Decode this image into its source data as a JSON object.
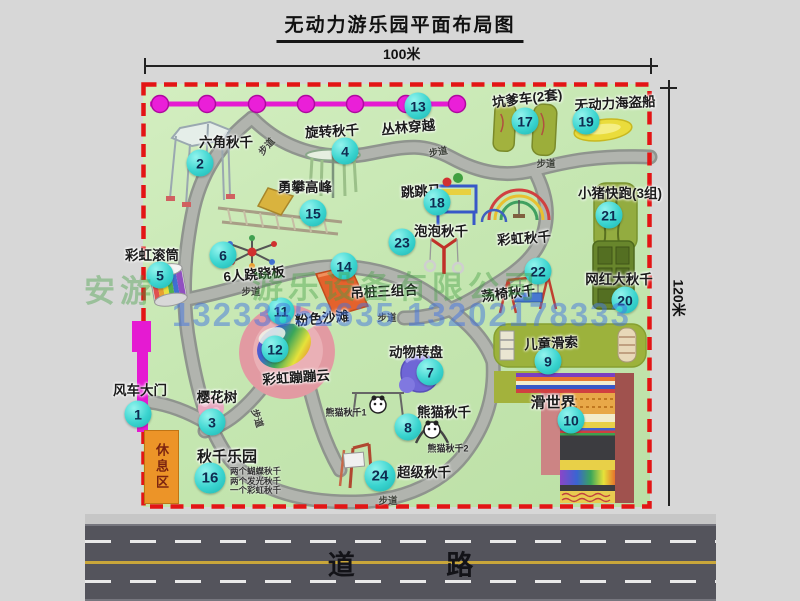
{
  "title": "无动力游乐园平面布局图",
  "dimensions": {
    "width_label": "100米",
    "height_label": "120米"
  },
  "road_label": "道 路",
  "walkway_label": "步道",
  "rest_area_label": "休息区",
  "rainbow_swing_label": "彩虹秋千",
  "panda_swing_1": "熊猫秋千1",
  "panda_swing_2": "熊猫秋千2",
  "swing_park_details": [
    "两个蝴蝶秋千",
    "两个发光秋千",
    "一个彩虹秋千"
  ],
  "watermark": {
    "fragment": "安游",
    "company": "游乐设备有限公司",
    "phone": "13233852635 13202178333"
  },
  "attractions": [
    {
      "num": "1",
      "name": "风车大门"
    },
    {
      "num": "2",
      "name": "六角秋千"
    },
    {
      "num": "3",
      "name": "樱花树"
    },
    {
      "num": "4",
      "name": "旋转秋千"
    },
    {
      "num": "5",
      "name": "彩虹滚筒"
    },
    {
      "num": "6",
      "name": "6人跷跷板"
    },
    {
      "num": "7",
      "name": "动物转盘"
    },
    {
      "num": "8",
      "name": "熊猫秋千"
    },
    {
      "num": "9",
      "name": "儿童滑索"
    },
    {
      "num": "10",
      "name": "滑世界"
    },
    {
      "num": "11",
      "name": "粉色沙滩"
    },
    {
      "num": "12",
      "name": "彩虹蹦蹦云"
    },
    {
      "num": "13",
      "name": "丛林穿越"
    },
    {
      "num": "14",
      "name": "吊桩三组合"
    },
    {
      "num": "15",
      "name": "勇攀高峰"
    },
    {
      "num": "16",
      "name": "秋千乐园"
    },
    {
      "num": "17",
      "name": "坑爹车(2套)"
    },
    {
      "num": "18",
      "name": "跳跳马"
    },
    {
      "num": "19",
      "name": "无动力海盗船"
    },
    {
      "num": "20",
      "name": "网红大秋千"
    },
    {
      "num": "21",
      "name": "小猪快跑(3组)"
    },
    {
      "num": "22",
      "name": "荡椅秋千"
    },
    {
      "num": "23",
      "name": "泡泡秋千"
    },
    {
      "num": "24",
      "name": "超级秋千"
    }
  ],
  "colors": {
    "park_green": "#c6e7b2",
    "border_red": "#e31515",
    "badge_cyan": "#3ad4cf",
    "path_gray": "#adb0ac",
    "gate_magenta": "#e51ad2",
    "road_gray": "#54545c",
    "watermark_green": "#46a046",
    "watermark_blue": "#4173e1"
  }
}
